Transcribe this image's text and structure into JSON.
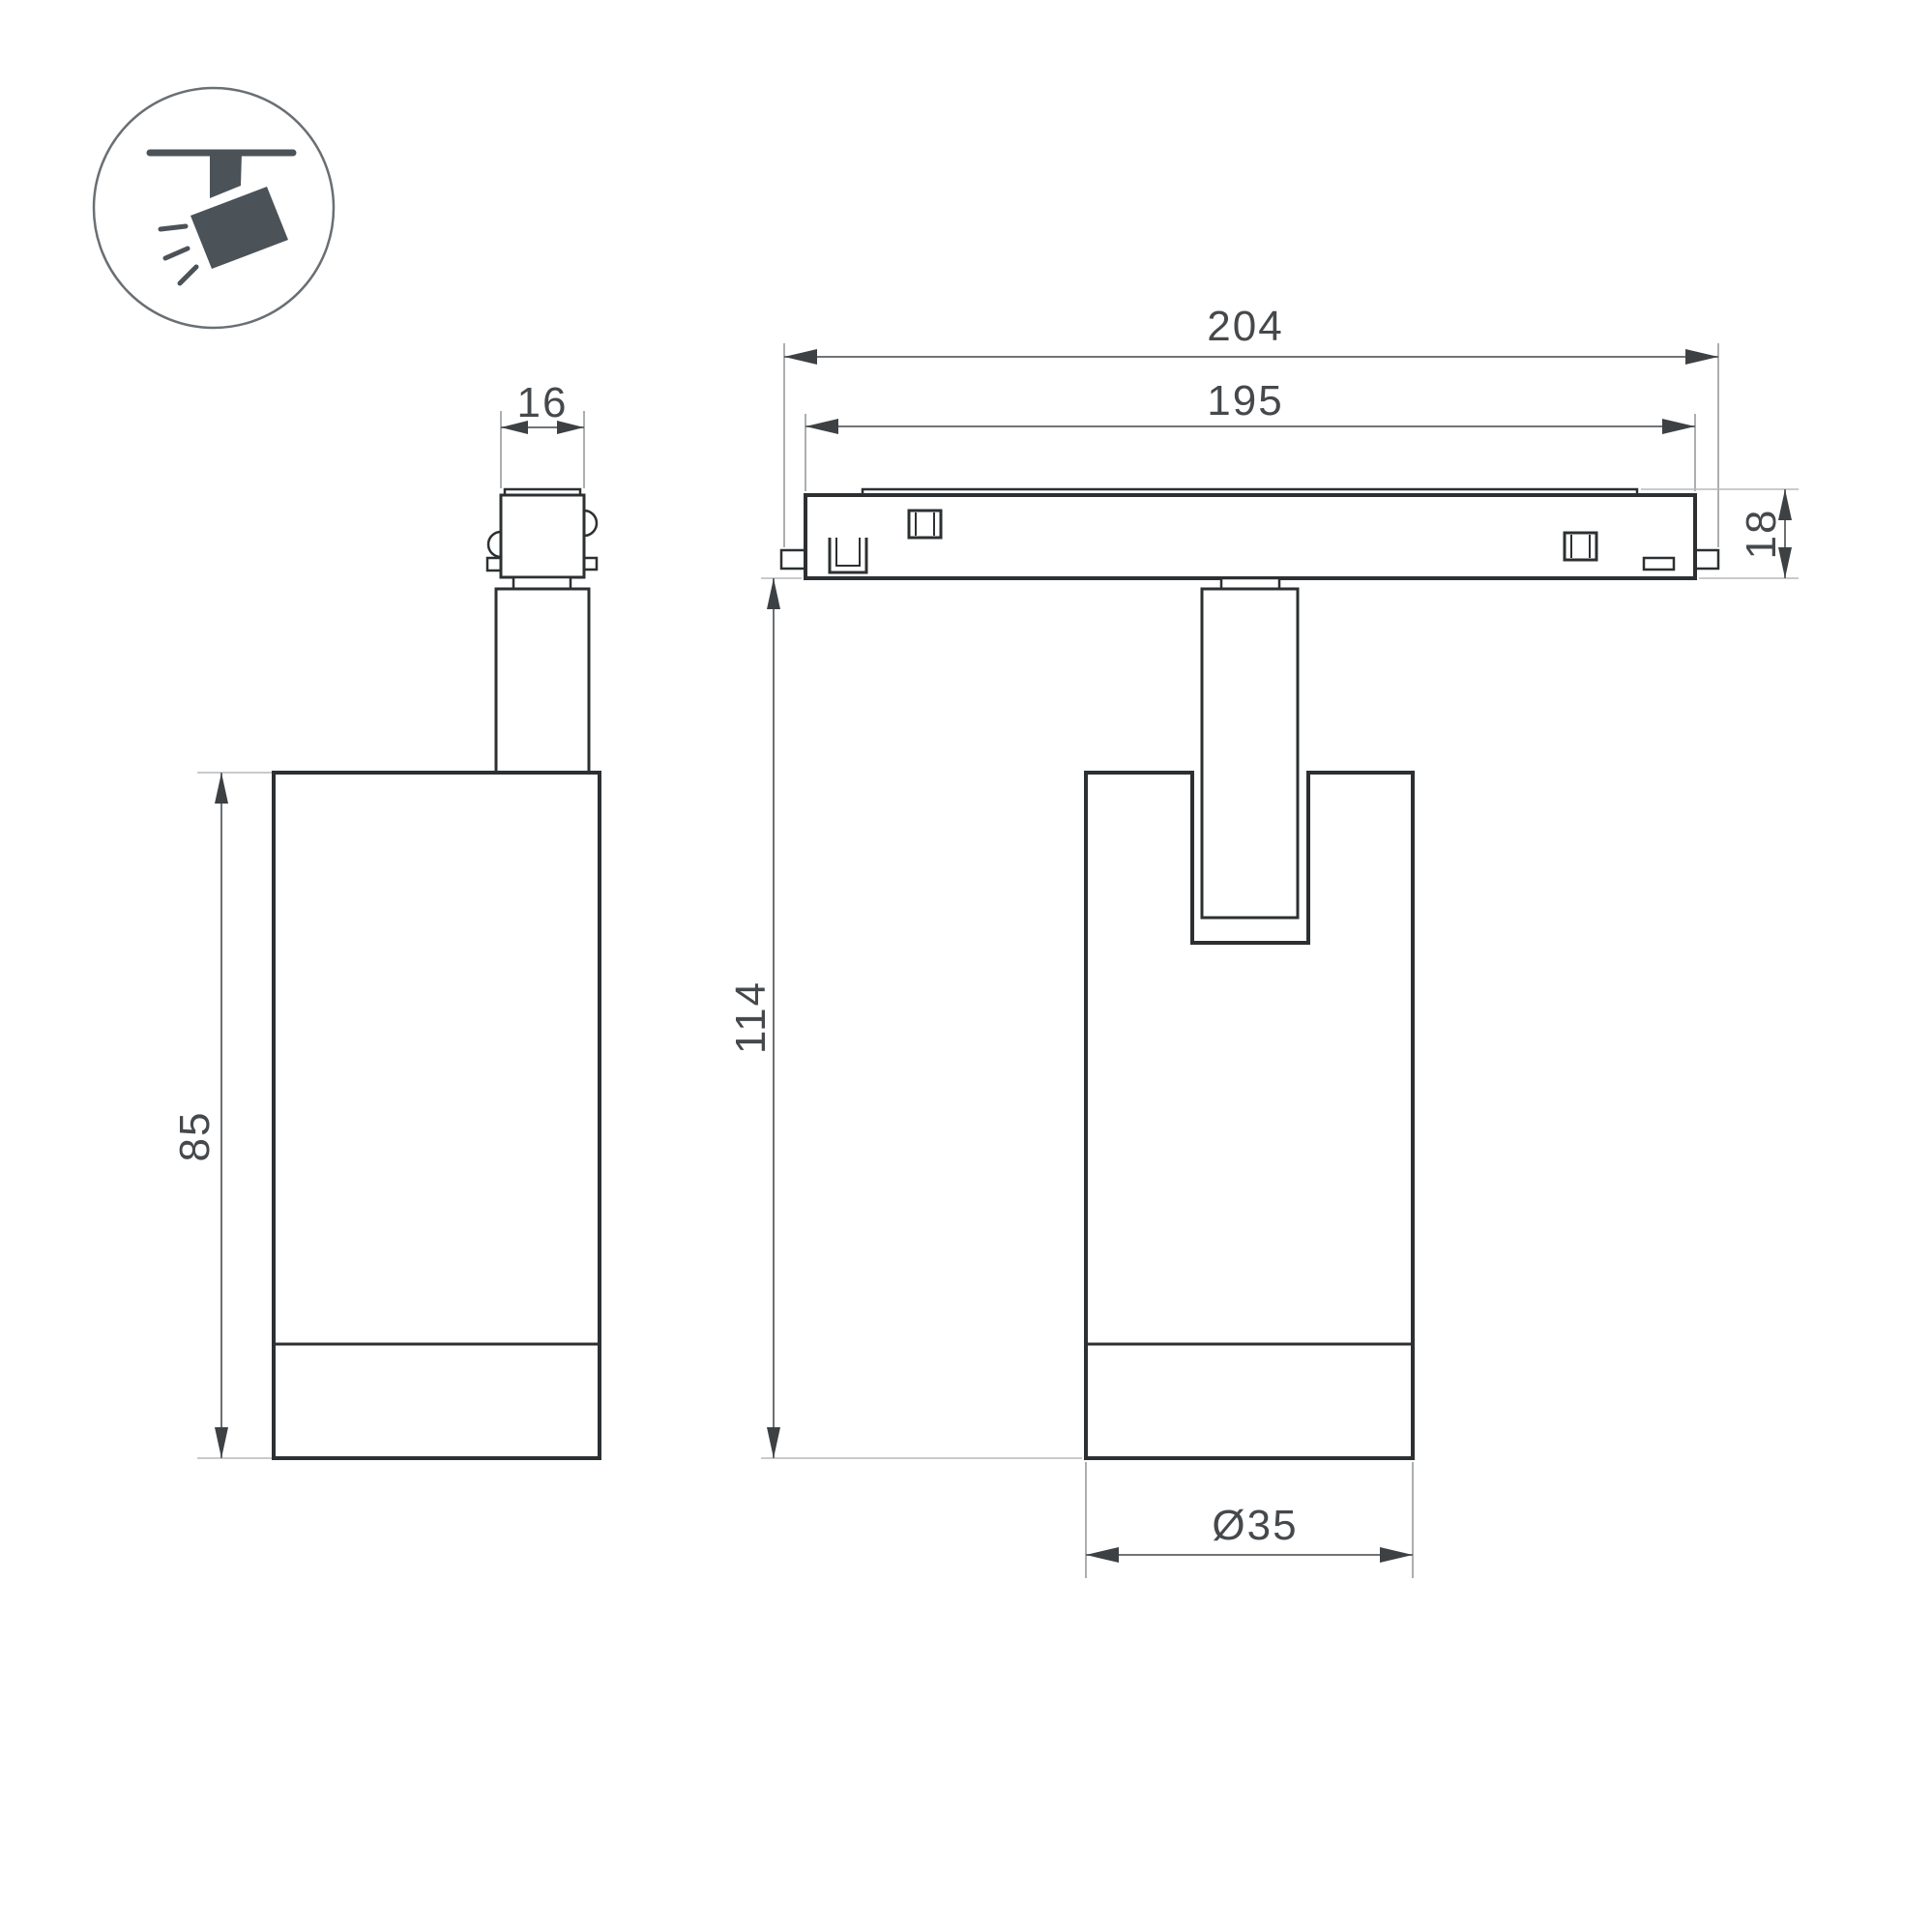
{
  "drawing": {
    "type": "technical-dimension-drawing",
    "subject": "magnetic track spotlight luminaire, two orthographic views",
    "icon": {
      "name": "ceiling-spotlight-icon"
    },
    "colors": {
      "background": "#ffffff",
      "outline": "#2d3032",
      "dimension_line": "#5c6062",
      "extension_line": "#989b9d",
      "arrowhead": "#3d4144",
      "text": "#46494c",
      "icon": "#4b5258"
    },
    "dimensions": {
      "side_width": "16",
      "side_height": "85",
      "track_outer_length": "204",
      "track_inner_length": "195",
      "track_height": "18",
      "total_height": "114",
      "body_diameter": "Ø35"
    }
  }
}
